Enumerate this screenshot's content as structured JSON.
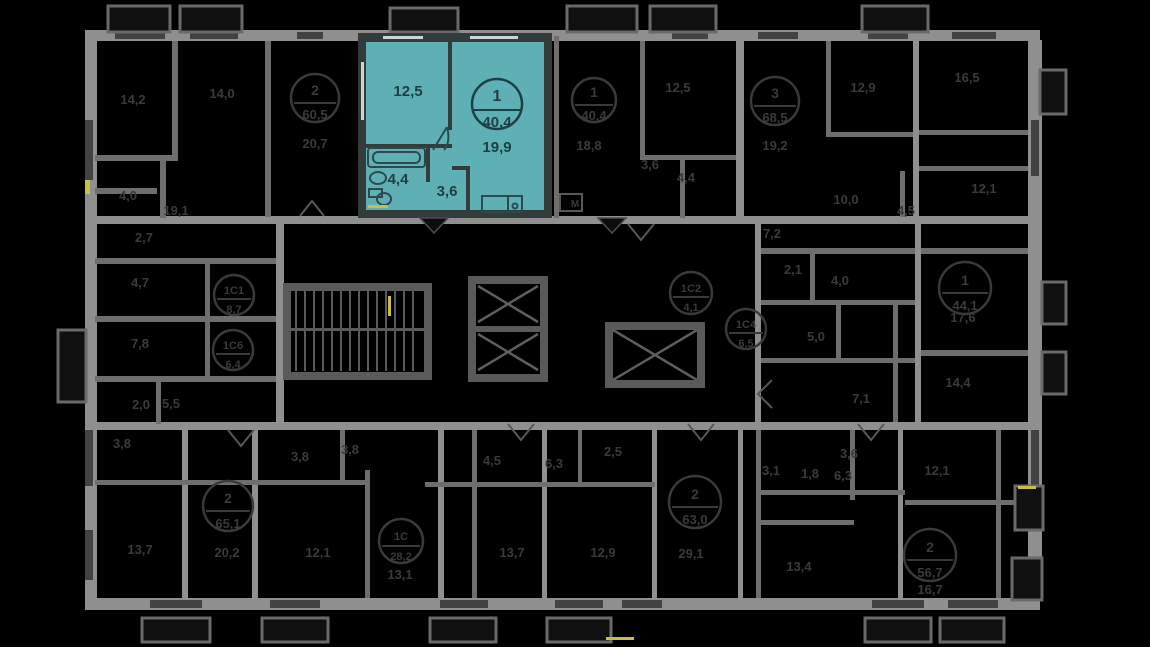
{
  "view": {
    "description": "Residential floor plan with one highlighted apartment",
    "background": "#000000"
  },
  "colors": {
    "dim_wall": "#8f8f8f",
    "dim_wall_secondary": "#6e6e6e",
    "dim_text": "#3a3a3a",
    "highlight_fill": "#5FB0B5",
    "highlight_wall": "#333B3B",
    "highlight_text": "#1E4044",
    "accent_yellow": "#C9C13B"
  },
  "highlighted_apartment": {
    "type": "1",
    "area": "40,4",
    "rooms": [
      {
        "label": "12,5"
      },
      {
        "label": "19,9"
      },
      {
        "label": "4,4"
      },
      {
        "label": "3,6"
      }
    ]
  },
  "badges": [
    {
      "top": "1",
      "bottom": "40,4"
    },
    {
      "top": "2",
      "bottom": "60,5"
    },
    {
      "top": "3",
      "bottom": "68,5"
    },
    {
      "top": "1С1",
      "bottom": "8,7"
    },
    {
      "top": "1С6",
      "bottom": "6,4"
    },
    {
      "top": "1С2",
      "bottom": "4,1"
    },
    {
      "top": "1С4",
      "bottom": "6,5"
    },
    {
      "top": "1",
      "bottom": "44,1"
    },
    {
      "top": "2",
      "bottom": "65,1"
    },
    {
      "top": "2",
      "bottom": "63,0"
    },
    {
      "top": "1С",
      "bottom": "28,2"
    },
    {
      "top": "2",
      "bottom": "56,7"
    }
  ],
  "labels": [
    {
      "t": "14,2"
    },
    {
      "t": "14,0"
    },
    {
      "t": "20,7"
    },
    {
      "t": "4,0"
    },
    {
      "t": "19,1"
    },
    {
      "t": "2,7"
    },
    {
      "t": "4,7"
    },
    {
      "t": "7,8"
    },
    {
      "t": "2,0"
    },
    {
      "t": "5,5"
    },
    {
      "t": "18,8"
    },
    {
      "t": "12,5"
    },
    {
      "t": "3,6"
    },
    {
      "t": "4,4"
    },
    {
      "t": "19,2"
    },
    {
      "t": "12,9"
    },
    {
      "t": "10,0"
    },
    {
      "t": "16,5"
    },
    {
      "t": "12,1"
    },
    {
      "t": "4,5"
    },
    {
      "t": "7,2"
    },
    {
      "t": "2,1"
    },
    {
      "t": "4,0"
    },
    {
      "t": "5,0"
    },
    {
      "t": "17,6"
    },
    {
      "t": "14,4"
    },
    {
      "t": "7,1"
    },
    {
      "t": "3,8"
    },
    {
      "t": "13,7"
    },
    {
      "t": "20,2"
    },
    {
      "t": "3,8"
    },
    {
      "t": "3,8"
    },
    {
      "t": "12,1"
    },
    {
      "t": "13,1"
    },
    {
      "t": "4,5"
    },
    {
      "t": "6,3"
    },
    {
      "t": "2,5"
    },
    {
      "t": "13,7"
    },
    {
      "t": "12,9"
    },
    {
      "t": "29,1"
    },
    {
      "t": "3,1"
    },
    {
      "t": "3,6"
    },
    {
      "t": "1,8"
    },
    {
      "t": "6,3"
    },
    {
      "t": "12,1"
    },
    {
      "t": "13,4"
    },
    {
      "t": "16,7"
    },
    {
      "t": "М"
    }
  ]
}
